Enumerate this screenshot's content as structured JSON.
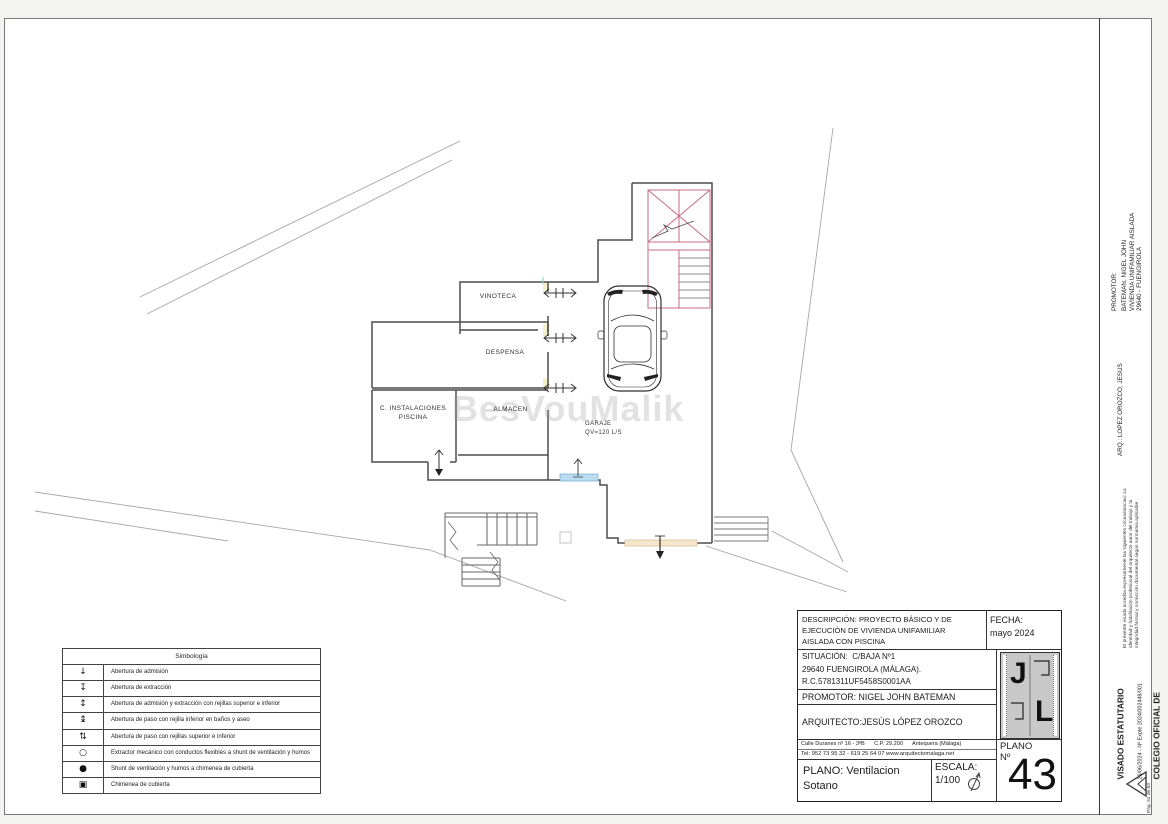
{
  "page": {
    "watermark": "BesVouMalik"
  },
  "plan": {
    "rooms": {
      "vinoteca": "VINOTECA",
      "despensa": "DESPENSA",
      "almacen": "ALMACEN",
      "piscina_line1": "C. INSTALACIONES",
      "piscina_line2": "PISCINA",
      "garaje": "GARAJE",
      "garaje_sub": "QV=120 L/S"
    }
  },
  "legend": {
    "title": "Simbología",
    "rows": [
      {
        "symbol": "↓",
        "text": "Abertura de admisión"
      },
      {
        "symbol": "↧",
        "text": "Abertura de extracción"
      },
      {
        "symbol": "↕",
        "text": "Abertura de admisión y extracción con rejillas superior e inferior"
      },
      {
        "symbol": "↨",
        "text": "Abertura de paso con rejilla inferior en baños y aseo"
      },
      {
        "symbol": "⇅",
        "text": "Abertura de paso con rejillas superior e inferior"
      },
      {
        "symbol": "○",
        "text": "Extractor mecánico con conductos flexibles a shunt de ventilación y humos"
      },
      {
        "symbol": "●",
        "text": "Shunt de ventilación y humos a chimenea de cubierta"
      },
      {
        "symbol": "▣",
        "text": "Chimenea de cubierta"
      }
    ]
  },
  "title_block": {
    "descripcion": "DESCRIPCIÓN: PROYECTO BÁSICO Y DE EJECUCIÓN DE VIVIENDA UNIFAMILIAR AISLADA CON PISCINA",
    "fecha_label": "FECHA:",
    "fecha_value": "mayo  2024",
    "situacion_line1": "SITUACIÓN:  C/BAJA Nº1",
    "situacion_line2": "29640 FUENGIROLA (MÁLAGA).",
    "situacion_line3": "R.C.5781311UF5458S0001AA",
    "promotor": "PROMOTOR: NIGEL JOHN BATEMAN",
    "arquitecto": "ARQUITECTO:JESÚS LÓPEZ OROZCO",
    "address_line1": "Calle Duranes nº 16 - 3ºB      C.P. 29.200      Antequera (Málaga)",
    "address_line2": "Tel: 952 73 95 32 - 619 25 64 07 www.arquitectomalaga.net",
    "plano_line1": "PLANO: Ventilacion",
    "plano_line2": "Sotano",
    "escala_label": "ESCALA:",
    "escala_value": "1/100",
    "logo_letter1": "J",
    "logo_letter2": "L",
    "plano_no_label1": "PLANO",
    "plano_no_label2": "Nº",
    "plano_number": "43"
  },
  "side_strip": {
    "promotor_label": "PROMOTOR:",
    "promotor_line1": "BATEMAN, NIGEL JOHN",
    "promotor_line2": "VIVIENDA UNIFAMILIAR AISLADA",
    "promotor_line3": "29640 - FUENGIROLA",
    "arq": "ARQ.: LOPEZ OROZCO, JESUS",
    "visado_note": "El presente visado acredita expresamente las siguientes circunstancias: La identidad y habilitación profesional del arquitecto autor del trabajo y la integridad formal y corrección documental según normativa aplicable",
    "visado_title": "VISADO ESTATUTARIO",
    "visado_expte": "26/06/2024 - Nº Expte 2024/002448/001",
    "colegio_line1": "COLEGIO OFICIAL DE",
    "colegio_line2": "ARQUITECTOS DE MÁLAGA",
    "page_number": "Pág. 52 de 63"
  },
  "colors": {
    "stair_pink": "#c76b80",
    "vent_blue": "#b8dcf0",
    "vent_orange": "#f6e7cb"
  }
}
